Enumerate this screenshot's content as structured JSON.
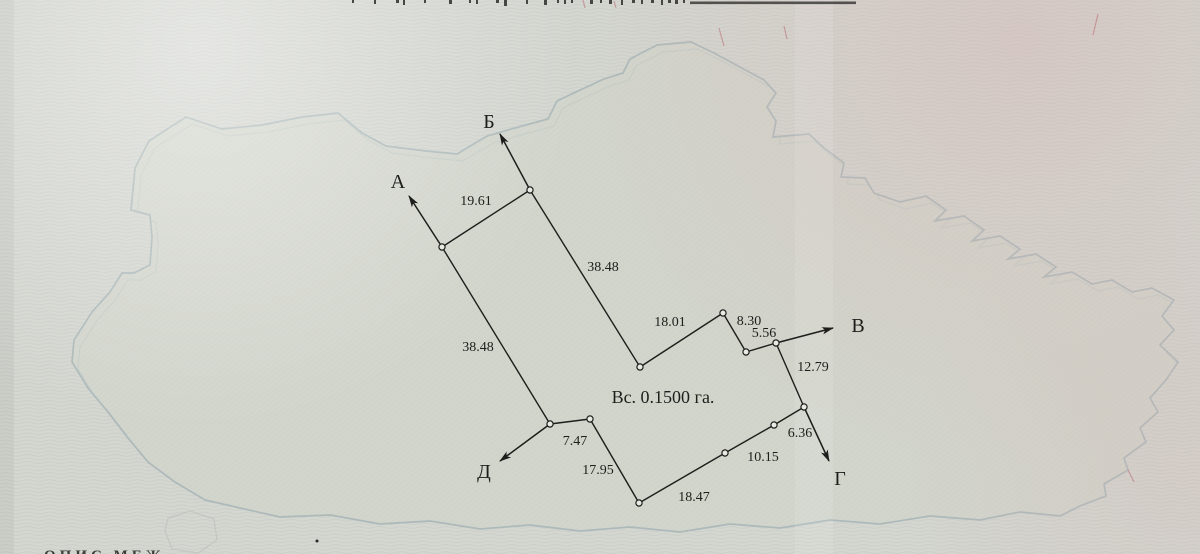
{
  "plan": {
    "area_label": {
      "text": "Вс. 0.1500 га.",
      "x": 663,
      "y": 403
    },
    "vertices": [
      {
        "x": 442,
        "y": 247
      },
      {
        "x": 530,
        "y": 190
      },
      {
        "x": 640,
        "y": 367
      },
      {
        "x": 723,
        "y": 313
      },
      {
        "x": 746,
        "y": 352
      },
      {
        "x": 776,
        "y": 343
      },
      {
        "x": 804,
        "y": 407
      },
      {
        "x": 774,
        "y": 425
      },
      {
        "x": 725,
        "y": 453
      },
      {
        "x": 639,
        "y": 503
      },
      {
        "x": 590,
        "y": 419
      },
      {
        "x": 550,
        "y": 424
      }
    ],
    "edges": [
      {
        "from": 0,
        "to": 1,
        "label": "19.61",
        "lx": 476,
        "ly": 205
      },
      {
        "from": 1,
        "to": 2,
        "label": "38.48",
        "lx": 603,
        "ly": 271
      },
      {
        "from": 2,
        "to": 3,
        "label": "18.01",
        "lx": 670,
        "ly": 326
      },
      {
        "from": 3,
        "to": 4,
        "label": "8.30",
        "lx": 749,
        "ly": 325
      },
      {
        "from": 4,
        "to": 5,
        "label": "5.56",
        "lx": 764,
        "ly": 337
      },
      {
        "from": 5,
        "to": 6,
        "label": "12.79",
        "lx": 813,
        "ly": 371
      },
      {
        "from": 6,
        "to": 7,
        "label": "6.36",
        "lx": 800,
        "ly": 437
      },
      {
        "from": 7,
        "to": 8,
        "label": "10.15",
        "lx": 763,
        "ly": 461
      },
      {
        "from": 8,
        "to": 9,
        "label": "18.47",
        "lx": 694,
        "ly": 501
      },
      {
        "from": 9,
        "to": 10,
        "label": "17.95",
        "lx": 598,
        "ly": 474
      },
      {
        "from": 10,
        "to": 11,
        "label": "7.47",
        "lx": 575,
        "ly": 445
      },
      {
        "from": 11,
        "to": 0,
        "label": "38.48",
        "lx": 478,
        "ly": 351
      }
    ],
    "rays": [
      {
        "letter": "А",
        "from": 0,
        "tip": [
          409,
          196
        ],
        "lx": 398,
        "ly": 188
      },
      {
        "letter": "Б",
        "from": 1,
        "tip": [
          500,
          134
        ],
        "lx": 489,
        "ly": 128
      },
      {
        "letter": "В",
        "from": 5,
        "tip": [
          833,
          328
        ],
        "lx": 858,
        "ly": 332
      },
      {
        "letter": "Г",
        "from": 6,
        "tip": [
          829,
          461
        ],
        "lx": 840,
        "ly": 485
      },
      {
        "letter": "Д",
        "from": 11,
        "tip": [
          500,
          461
        ],
        "lx": 484,
        "ly": 478
      }
    ]
  },
  "scan": {
    "bottom_text": "ОПИС МЕЖ"
  }
}
